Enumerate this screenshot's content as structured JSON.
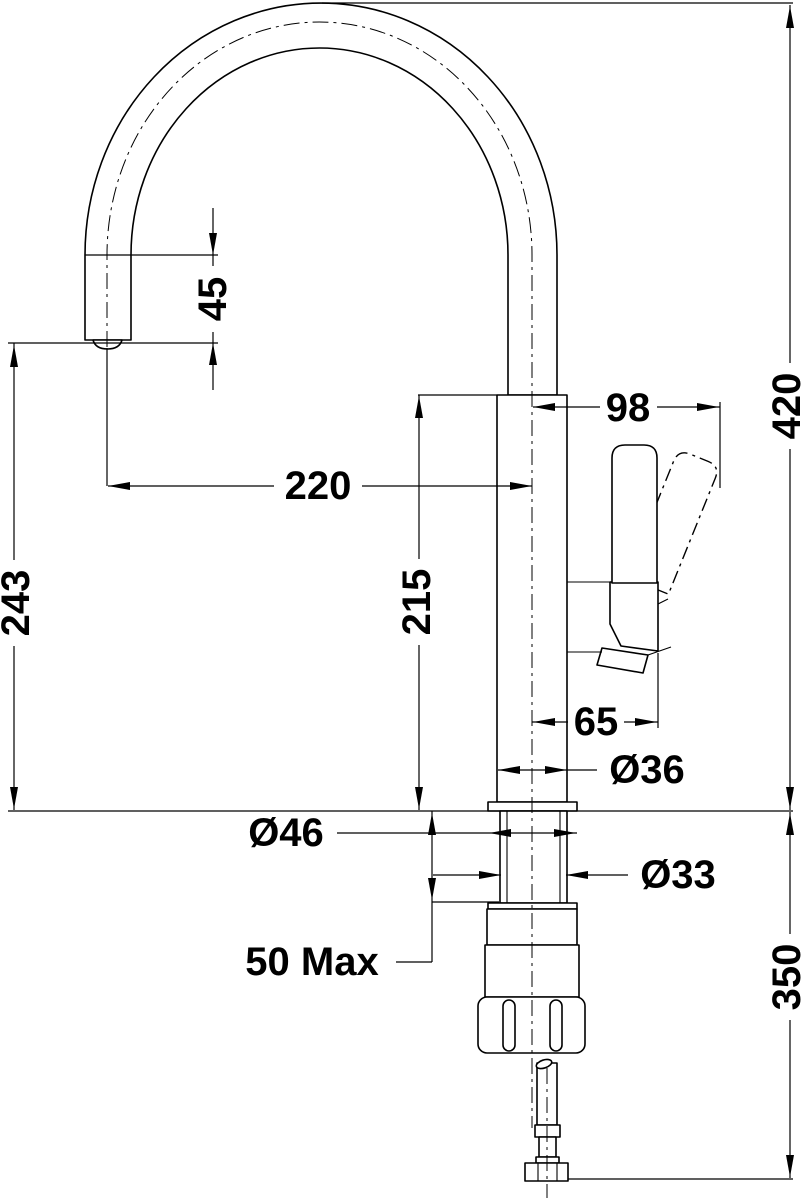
{
  "drawing": {
    "type": "technical-dimension-drawing",
    "subject": "kitchen-mixer-tap-side-view",
    "background_color": "#ffffff",
    "line_color": "#000000"
  },
  "dimensions": {
    "spout_end_drop": {
      "label": "45",
      "orientation": "vertical"
    },
    "spout_reach": {
      "label": "220",
      "orientation": "horizontal"
    },
    "spout_outlet_height": {
      "label": "243",
      "orientation": "vertical"
    },
    "body_top_height": {
      "label": "215",
      "orientation": "vertical"
    },
    "total_height": {
      "label": "420",
      "orientation": "vertical"
    },
    "handle_reach": {
      "label": "98",
      "orientation": "horizontal"
    },
    "handle_offset": {
      "label": "65",
      "orientation": "horizontal"
    },
    "body_diameter": {
      "label": "Ø36",
      "orientation": "horizontal"
    },
    "flange_diameter": {
      "label": "Ø46",
      "orientation": "horizontal"
    },
    "shank_diameter": {
      "label": "Ø33",
      "orientation": "horizontal"
    },
    "max_counter_thickness": {
      "label": "50 Max",
      "orientation": "horizontal"
    },
    "under_counter_length": {
      "label": "350",
      "orientation": "vertical"
    }
  }
}
